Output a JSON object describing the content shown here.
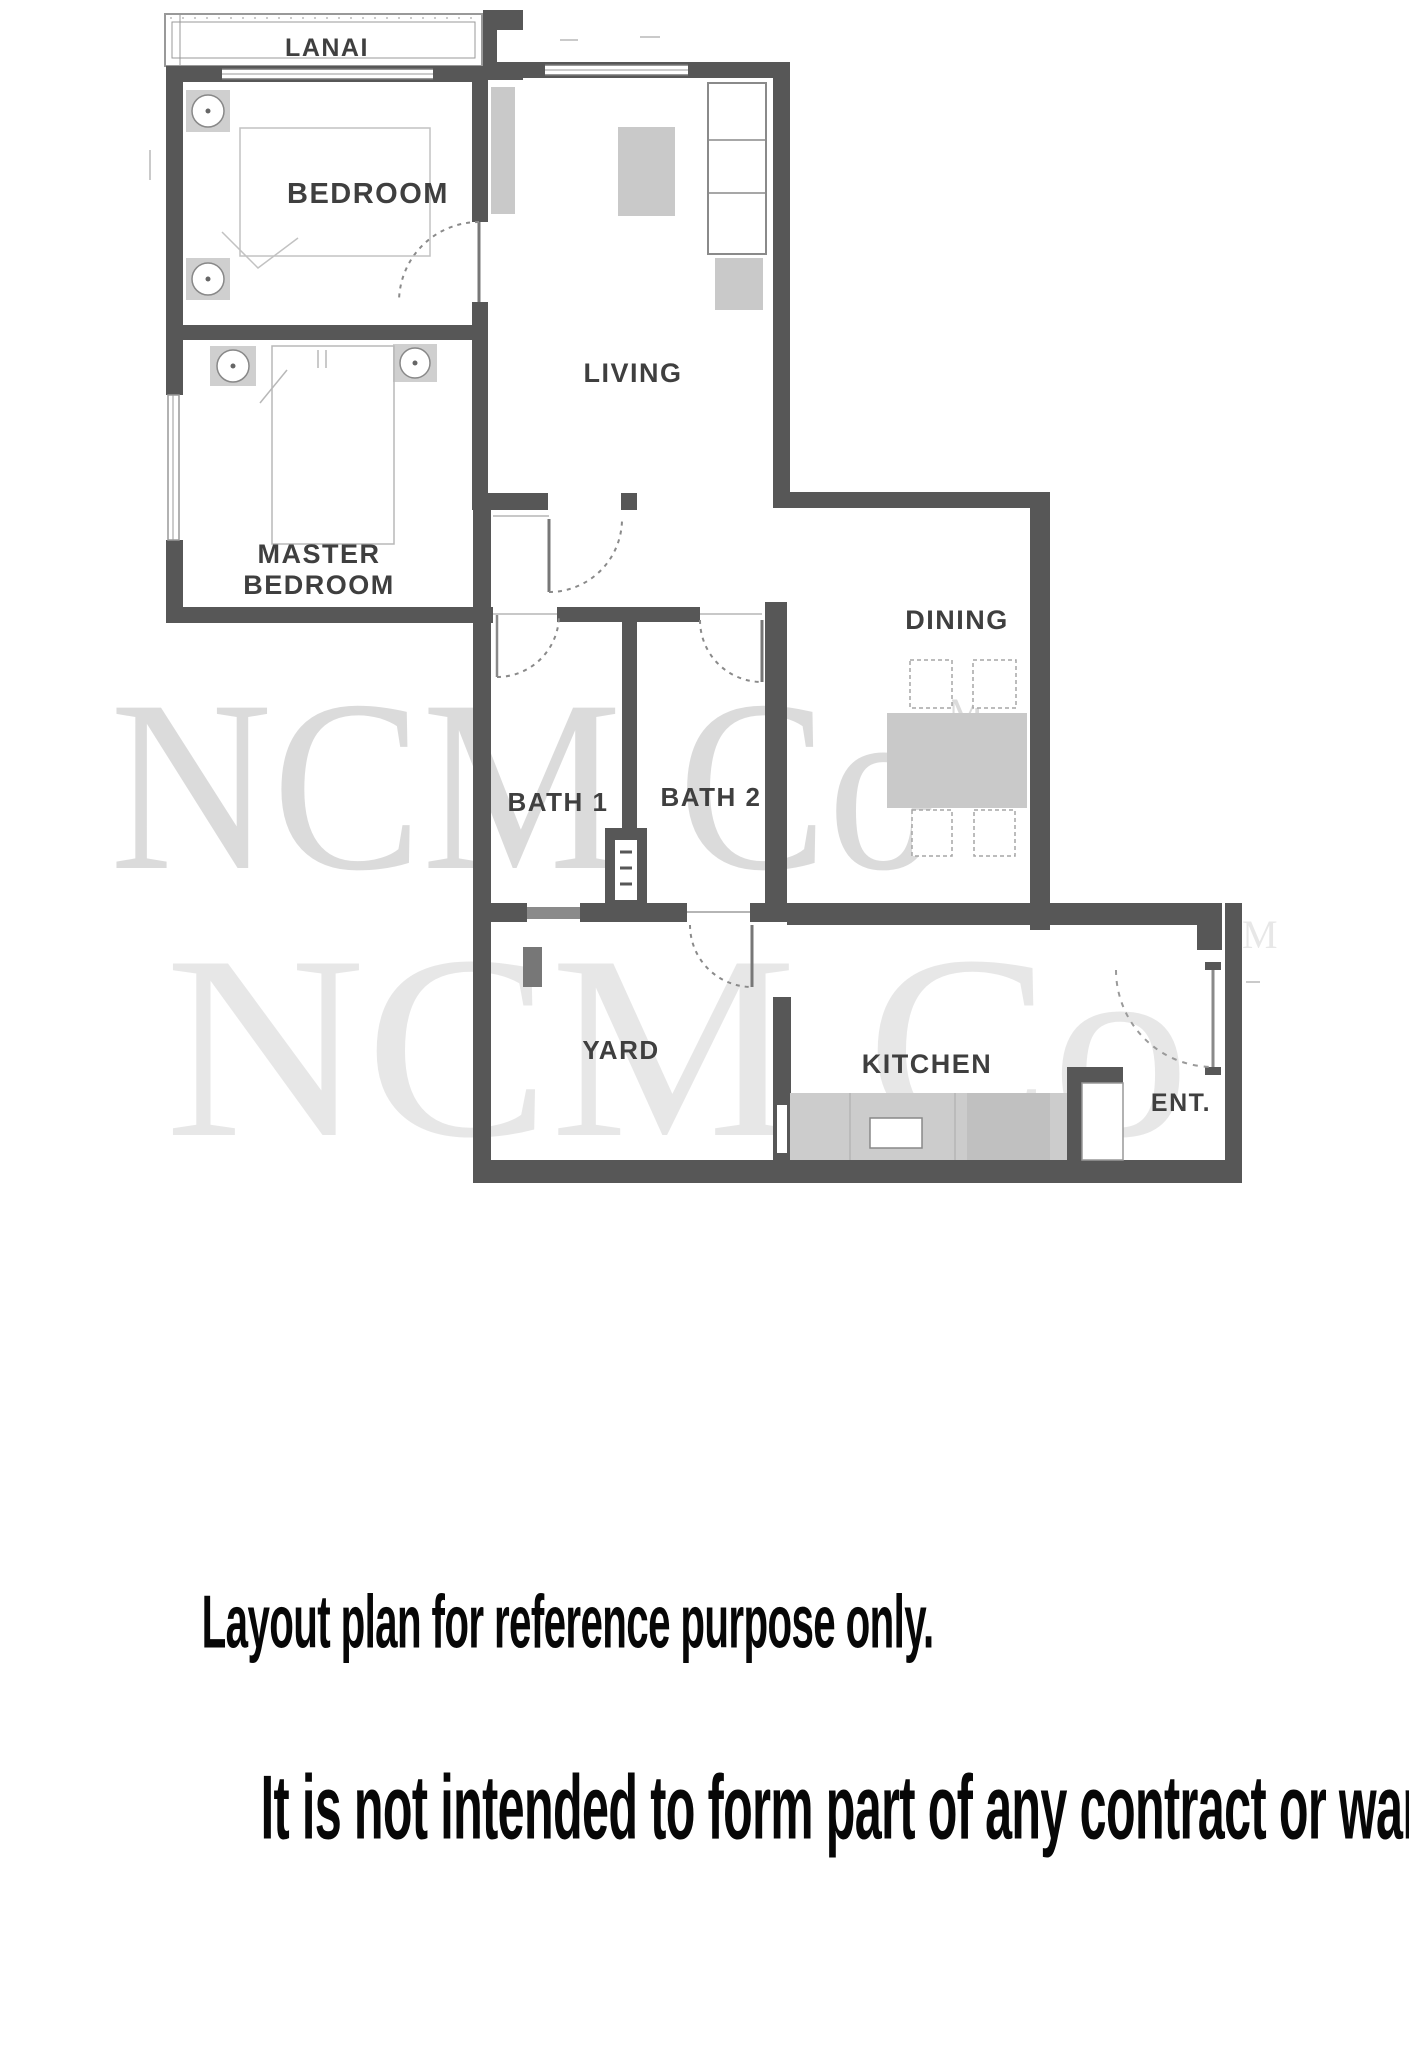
{
  "floor_plan": {
    "room_labels": {
      "lanai": "LANAI",
      "bedroom": "BEDROOM",
      "living": "LIVING",
      "master_bedroom_line1": "MASTER",
      "master_bedroom_line2": "BEDROOM",
      "bath1": "BATH 1",
      "bath2": "BATH 2",
      "dining": "DINING",
      "yard": "YARD",
      "kitchen": "KITCHEN",
      "entrance": "ENT."
    },
    "watermark": {
      "text": "NCM Co",
      "tm_mark": "M"
    },
    "colors": {
      "wall": "#575757",
      "furniture_fill": "#c9c9c9",
      "thin_line": "#8d8d8d",
      "label_text": "#3f3f3f",
      "watermark_gray": "#8c8c8c"
    }
  },
  "disclaimer": {
    "line1": "Layout plan for reference purpose only.",
    "line2": "It is not intended to form part of any contract or warranty."
  }
}
